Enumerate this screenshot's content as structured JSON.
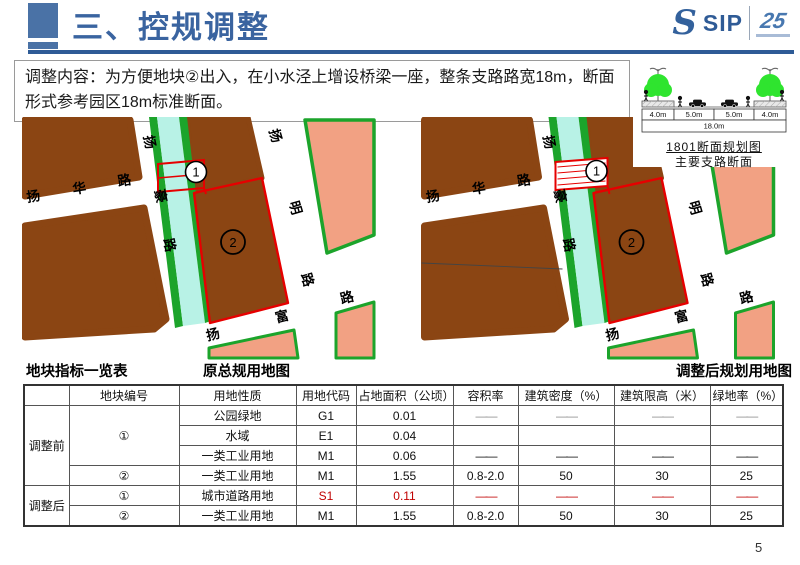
{
  "header": {
    "title": "三、控规调整",
    "logo": {
      "s_glyph": "S",
      "sip": "SIP",
      "anniversary": "25"
    }
  },
  "intro": {
    "text": "调整内容：为方便地块②出入，在小水泾上增设桥梁一座，整条支路路宽18m，断面形式参考园区18m标准断面。"
  },
  "section_diagram": {
    "dims": [
      "4.0m",
      "5.0m",
      "5.0m",
      "4.0m"
    ],
    "total": "18.0m",
    "caption_line1": "1801断面规划图",
    "caption_line2": "主要支路断面"
  },
  "maps": {
    "left_caption": "原总规用地图",
    "right_caption": "调整后规划用地图",
    "num1": "1",
    "num2": "2",
    "road_yanghua": [
      "扬",
      "华",
      "路"
    ],
    "road_yanghao": [
      "扬",
      "豪",
      "路"
    ],
    "road_yangming": [
      "扬",
      "明",
      "路"
    ],
    "road_yangfu": [
      "扬",
      "富",
      "路"
    ],
    "colors": {
      "industrial_brown": "#8B4513",
      "parcel_pink": "#F2A183",
      "river_cyan": "#B8F2E6",
      "green_edge": "#1CA42B",
      "outline_red": "#E60000"
    }
  },
  "table": {
    "caption": "地块指标一览表",
    "headers": [
      "",
      "地块编号",
      "用地性质",
      "用地代码",
      "占地面积（公顷）",
      "容积率",
      "建筑密度（%）",
      "建筑限高（米）",
      "绿地率（%）"
    ],
    "groups": {
      "before": "调整前",
      "after": "调整后"
    },
    "rows": [
      {
        "parcel": "①",
        "nature": "公园绿地",
        "code": "G1",
        "area": "0.01",
        "far": "——",
        "density": "——",
        "height": "——",
        "green": "——"
      },
      {
        "parcel": "",
        "nature": "水域",
        "code": "E1",
        "area": "0.04",
        "far": "",
        "density": "",
        "height": "",
        "green": ""
      },
      {
        "parcel": "",
        "nature": "一类工业用地",
        "code": "M1",
        "area": "0.06",
        "far": "——",
        "density": "——",
        "height": "——",
        "green": "——"
      },
      {
        "parcel": "②",
        "nature": "一类工业用地",
        "code": "M1",
        "area": "1.55",
        "far": "0.8-2.0",
        "density": "50",
        "height": "30",
        "green": "25"
      },
      {
        "parcel": "①",
        "nature": "城市道路用地",
        "code": "S1",
        "area": "0.11",
        "far": "——",
        "density": "——",
        "height": "——",
        "green": "——"
      },
      {
        "parcel": "②",
        "nature": "一类工业用地",
        "code": "M1",
        "area": "1.55",
        "far": "0.8-2.0",
        "density": "50",
        "height": "30",
        "green": "25"
      }
    ]
  },
  "page_number": "5"
}
